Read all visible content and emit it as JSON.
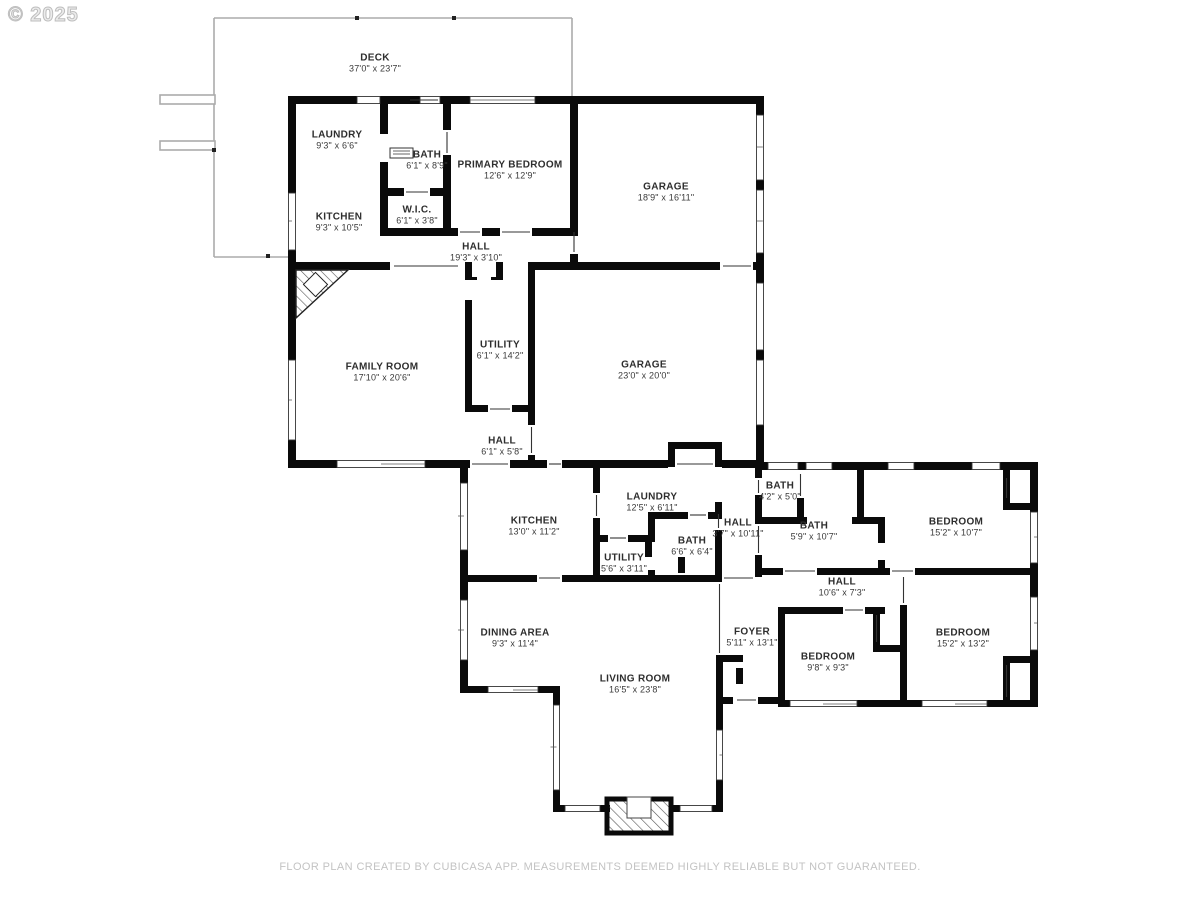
{
  "watermark": "© 2025",
  "footer": "FLOOR PLAN CREATED BY CUBICASA APP. MEASUREMENTS DEEMED HIGHLY RELIABLE BUT NOT GUARANTEED.",
  "rooms": [
    {
      "id": "deck",
      "name": "DECK",
      "dims": "37'0\" x 23'7\"",
      "x": 375,
      "y": 63
    },
    {
      "id": "laundry-upper",
      "name": "LAUNDRY",
      "dims": "9'3\" x 6'6\"",
      "x": 337,
      "y": 140
    },
    {
      "id": "bath-upper",
      "name": "BATH",
      "dims": "6'1\" x 8'9\"",
      "x": 427,
      "y": 160
    },
    {
      "id": "primary-bedroom",
      "name": "PRIMARY BEDROOM",
      "dims": "12'6\" x 12'9\"",
      "x": 510,
      "y": 170
    },
    {
      "id": "garage-upper",
      "name": "GARAGE",
      "dims": "18'9\" x 16'11\"",
      "x": 666,
      "y": 192
    },
    {
      "id": "kitchen-upper",
      "name": "KITCHEN",
      "dims": "9'3\" x 10'5\"",
      "x": 339,
      "y": 222
    },
    {
      "id": "wic",
      "name": "W.I.C.",
      "dims": "6'1\" x 3'8\"",
      "x": 417,
      "y": 215
    },
    {
      "id": "hall-upper",
      "name": "HALL",
      "dims": "19'3\" x 3'10\"",
      "x": 476,
      "y": 252
    },
    {
      "id": "family-room",
      "name": "FAMILY ROOM",
      "dims": "17'10\" x 20'6\"",
      "x": 382,
      "y": 372
    },
    {
      "id": "utility-mid",
      "name": "UTILITY",
      "dims": "6'1\" x 14'2\"",
      "x": 500,
      "y": 350
    },
    {
      "id": "garage-mid",
      "name": "GARAGE",
      "dims": "23'0\" x 20'0\"",
      "x": 644,
      "y": 370
    },
    {
      "id": "hall-mid",
      "name": "HALL",
      "dims": "6'1\" x 5'8\"",
      "x": 502,
      "y": 446
    },
    {
      "id": "kitchen-lower",
      "name": "KITCHEN",
      "dims": "13'0\" x 11'2\"",
      "x": 534,
      "y": 526
    },
    {
      "id": "laundry-lower",
      "name": "LAUNDRY",
      "dims": "12'5\" x 6'11\"",
      "x": 652,
      "y": 502
    },
    {
      "id": "utility-lower",
      "name": "UTILITY",
      "dims": "5'6\" x 3'11\"",
      "x": 624,
      "y": 563
    },
    {
      "id": "bath-hall",
      "name": "BATH",
      "dims": "6'6\" x 6'4\"",
      "x": 692,
      "y": 546
    },
    {
      "id": "hall-narrow",
      "name": "HALL",
      "dims": "3'7\" x 10'11\"",
      "x": 738,
      "y": 528
    },
    {
      "id": "bath-small",
      "name": "BATH",
      "dims": "4'2\" x 5'0\"",
      "x": 780,
      "y": 491
    },
    {
      "id": "bath-long",
      "name": "BATH",
      "dims": "5'9\" x 10'7\"",
      "x": 814,
      "y": 531
    },
    {
      "id": "bedroom-ne",
      "name": "BEDROOM",
      "dims": "15'2\" x 10'7\"",
      "x": 956,
      "y": 527
    },
    {
      "id": "hall-bedrooms",
      "name": "HALL",
      "dims": "10'6\" x 7'3\"",
      "x": 842,
      "y": 587
    },
    {
      "id": "dining-area",
      "name": "DINING AREA",
      "dims": "9'3\" x 11'4\"",
      "x": 515,
      "y": 638
    },
    {
      "id": "foyer",
      "name": "FOYER",
      "dims": "5'11\" x 13'1\"",
      "x": 752,
      "y": 637
    },
    {
      "id": "bedroom-small",
      "name": "BEDROOM",
      "dims": "9'8\" x 9'3\"",
      "x": 828,
      "y": 662
    },
    {
      "id": "bedroom-se",
      "name": "BEDROOM",
      "dims": "15'2\" x 13'2\"",
      "x": 963,
      "y": 638
    },
    {
      "id": "living-room",
      "name": "LIVING ROOM",
      "dims": "16'5\" x 23'8\"",
      "x": 635,
      "y": 684
    }
  ]
}
